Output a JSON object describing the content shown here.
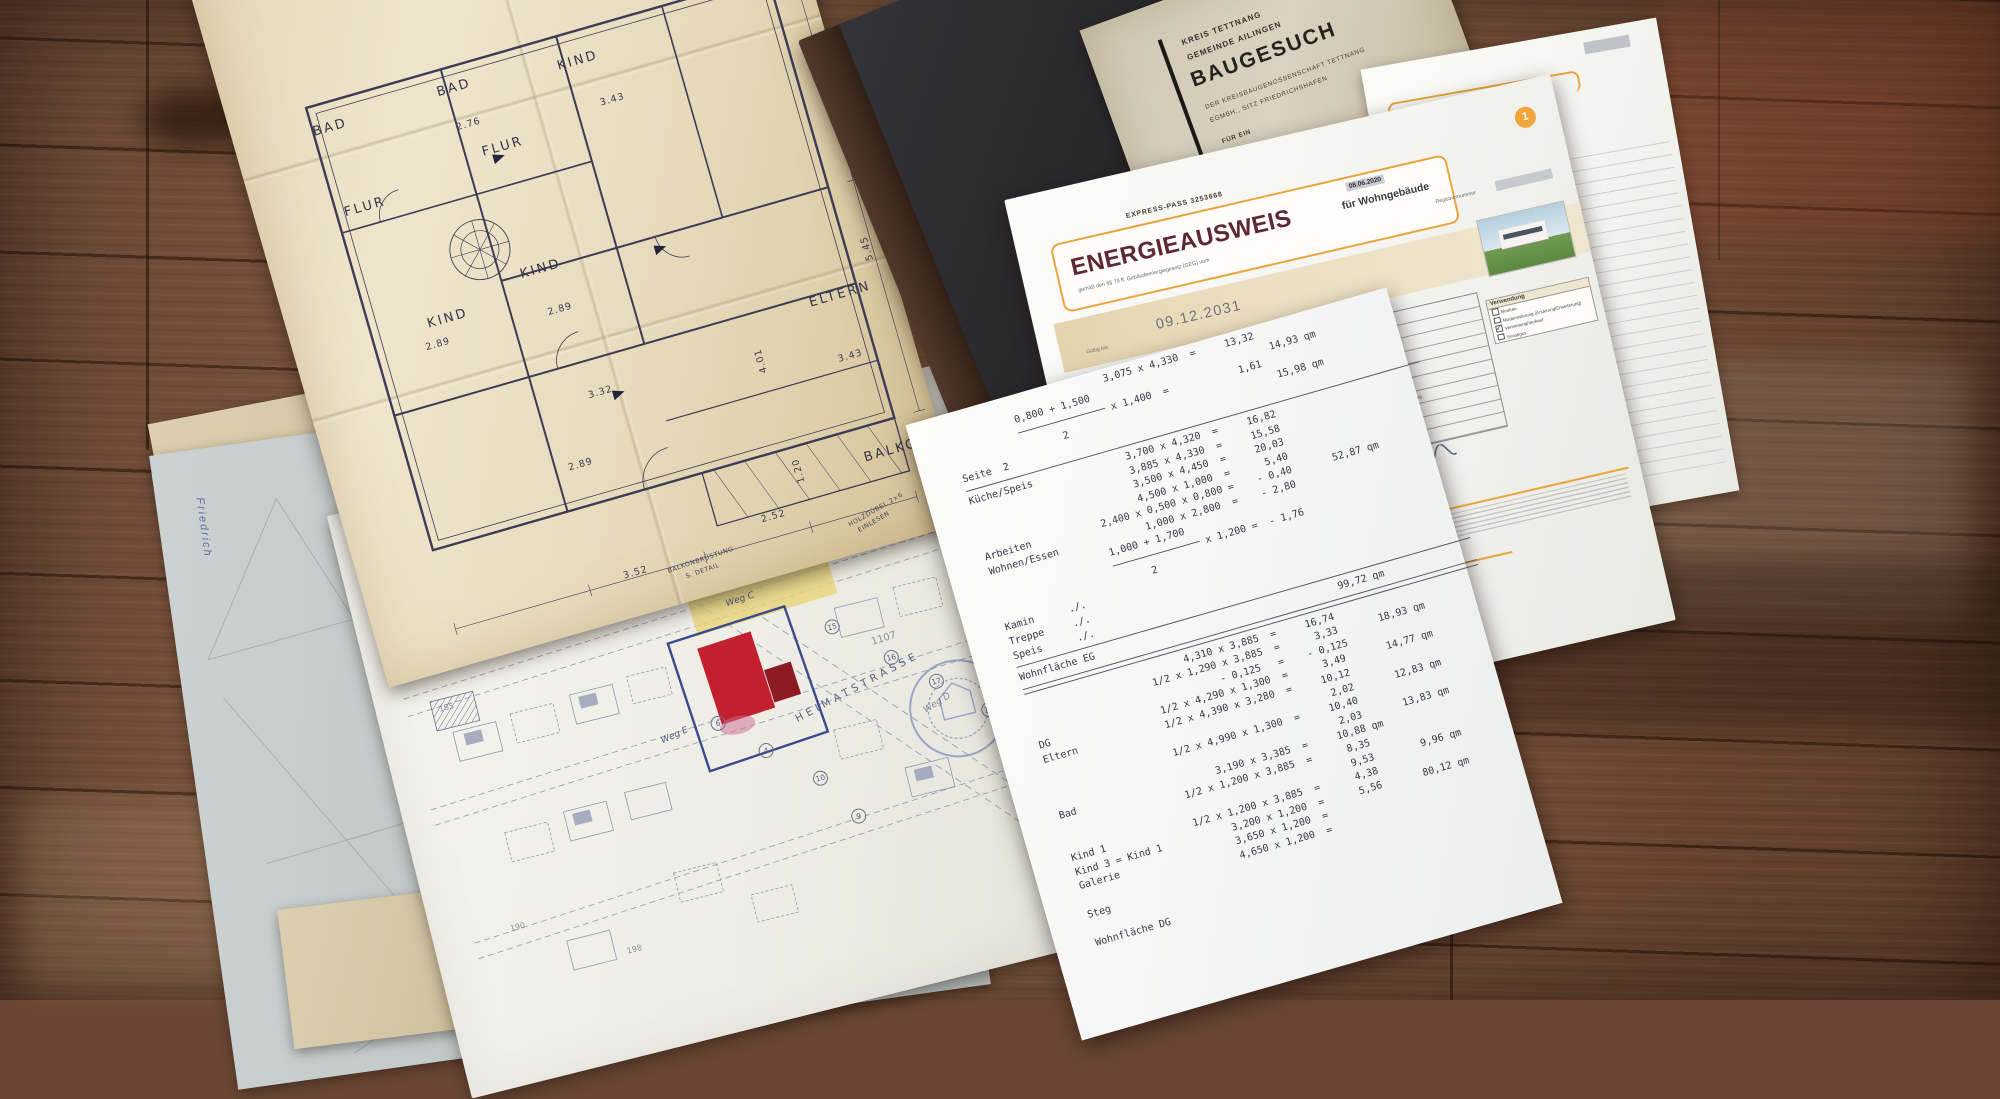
{
  "baugesuch": {
    "kreis": "KREIS TETTNANG",
    "gemeinde": "GEMEINDE AILINGEN",
    "title": "BAUGESUCH",
    "sub1": "DER KREISBAUGENOSSENSCHAFT TETTNANG",
    "sub2": "EGMBH., SITZ FRIEDRICHSHAFEN",
    "fuer": "FÜR EIN",
    "copy": "6. FERTIGUNG"
  },
  "energieausweis": {
    "express": "EXPRESS-PASS 3253668",
    "title": "ENERGIEAUSWEIS",
    "title_suffix": "für Wohngebäude",
    "law": "gemäß den §§ 79 ff. Gebäudeenergiegesetz (GEG) vom",
    "law_date": "08.06.2020",
    "page_badge": "1",
    "reg_label": "Registriernummer",
    "valid_label": "Gültig bis:",
    "valid_date": "09.12.2031",
    "form_values": [
      "Wohngebäude",
      "Objektstandort",
      "Raum Tettnang",
      "Einfamilienhaus",
      "2019",
      "2019",
      "1  (Wohnfläche: 168,0 m²)",
      "226,8 m²",
      "Wärmepumpe - Strom",
      "Wärmepumpe - Strom"
    ],
    "wohnflaeche_note": "nach § 92 GEG aus der Wohnfläche ermittelt",
    "verwendung_label": "Verwendung",
    "checkboxes_left": [
      {
        "t": "Fensterlüftung",
        "c": false
      },
      {
        "t": "Schachtlüftung",
        "c": false
      },
      {
        "t": "Passive Kühlung",
        "c": false
      },
      {
        "t": "Gelieferte Kälte",
        "c": false
      }
    ],
    "checkboxes_mid": [
      {
        "t": "Lüftungsanlage mit Wärmerückgewinnung",
        "c": true
      },
      {
        "t": "Lüftungsanlage ohne Wärmerückgewinnung",
        "c": false
      },
      {
        "t": "Kühlung aus Strom",
        "c": false
      },
      {
        "t": "Kühlung aus Wärme",
        "c": false
      }
    ],
    "checkboxes_right": [
      {
        "t": "Neubau",
        "c": false
      },
      {
        "t": "Modernisierung (Änderung/Erweiterung)",
        "c": false
      },
      {
        "t": "Vermietung/Verkauf",
        "c": true
      },
      {
        "t": "Sonstiges",
        "c": false
      }
    ],
    "anzahl_label": "Anzahl",
    "header1": "Hinweise zu den Angaben über die energetische Qualität des Gebäudes",
    "header2": "Hinweise zur Verwendung des Energieausweises",
    "stamp_date": "09.12.2021"
  },
  "calc_sheet": {
    "lines": [
      {
        "t": "                           3,075 x 4,330  =     13,32"
      },
      {
        "t": "           0,800 + 1,500                               14,93 qm"
      },
      {
        "t": "           ─────────────── x 1,400  =            1,61"
      },
      {
        "t": "                  2                                    15,98 qm"
      },
      {
        "t": "Seite  2"
      },
      {
        "rule": true,
        "w": 472,
        "ml": 0
      },
      {
        "t": "Küche/Speis                3,700 x 4,320  =     16,82"
      },
      {
        "t": "                           3,885 x 4,330  =     15,58"
      },
      {
        "t": "                           3,500 x 4,450  =     20,03"
      },
      {
        "t": "                           4,500 x 1,000  =      5,40"
      },
      {
        "t": "Arbeiten            2,400 x 0,500 x 0,800 =    - 0,40       52,87 qm"
      },
      {
        "t": "Wohnen/Essen               1,000 x 2,800  =    - 2,80"
      },
      {
        "t": "                    1,000 + 1,700"
      },
      {
        "t": "                    ─────────────── x 1,200 =  - 1,76"
      },
      {
        "t": "                          2"
      },
      {
        "t": "Kamin      ./."
      },
      {
        "t": "Treppe     ./."
      },
      {
        "t": "Speis      ./."
      },
      {
        "rule": true,
        "w": 472,
        "ml": 0
      },
      {
        "t": "Wohnfläche EG                                          99,72 qm"
      },
      {
        "rule": true,
        "w": 472,
        "ml": 0
      },
      {
        "rule": true,
        "w": 472,
        "ml": 0
      },
      {
        "t": "                           4,310 x 3,885  =     16,74"
      },
      {
        "t": "                     1/2 x 1,290 x 3,885  =      3,33       18,93 qm"
      },
      {
        "t": "                                - 0,125   =    - 0,125"
      },
      {
        "t": "DG                   1/2 x 4,290 x 1,300  =      3,49       14,77 qm"
      },
      {
        "t": "Eltern               1/2 x 4,390 x 3,280  =     10,12"
      },
      {
        "t": "                                                 2,02       12,83 qm"
      },
      {
        "t": "                     1/2 x 4,990 x 1,300  =     10,40"
      },
      {
        "t": "                                                 2,03       13,83 qm"
      },
      {
        "t": "Bad                        3,190 x 3,385  =     10,88 qm"
      },
      {
        "t": "                     1/2 x 1,200 x 3,885  =      8,35"
      },
      {
        "t": "                                                 9,53        9,96 qm"
      },
      {
        "t": "Kind 1               1/2 x 1,200 x 3,885  =      4,38"
      },
      {
        "t": "Kind 3 = Kind 1            3,200 x 1,200  =      5,56       80,12 qm"
      },
      {
        "t": "Galerie                    3,650 x 1,200  ="
      },
      {
        "t": "                           4,650 x 1,200  ="
      },
      {
        "t": "Steg"
      },
      {
        "t": ""
      },
      {
        "t": "Wohnfläche DG"
      }
    ]
  },
  "floorplan": {
    "rooms": [
      {
        "t": "BAD",
        "x": 210,
        "y": 214
      },
      {
        "t": "BAD",
        "x": 80,
        "y": 218
      },
      {
        "t": "KIND",
        "x": 333,
        "y": 222
      },
      {
        "t": "FLUR",
        "x": 237,
        "y": 284
      },
      {
        "t": "FLUR",
        "x": 88,
        "y": 304
      },
      {
        "t": "KIND",
        "x": 240,
        "y": 412
      },
      {
        "t": "KIND",
        "x": 137,
        "y": 434
      },
      {
        "t": "ELTERN",
        "x": 510,
        "y": 519
      },
      {
        "t": "BALKON",
        "x": 520,
        "y": 683
      }
    ],
    "dims": [
      {
        "t": "3.43",
        "x": 364,
        "y": 271
      },
      {
        "t": "2.76",
        "x": 219,
        "y": 255
      },
      {
        "t": "2.89",
        "x": 256,
        "y": 458
      },
      {
        "t": "2.89",
        "x": 129,
        "y": 458
      },
      {
        "t": "2.89",
        "x": 233,
        "y": 613
      },
      {
        "t": "3.43",
        "x": 522,
        "y": 583
      },
      {
        "t": "3.32",
        "x": 272,
        "y": 549
      },
      {
        "t": "3.52",
        "x": 256,
        "y": 732
      },
      {
        "t": "2.52",
        "x": 404,
        "y": 716
      },
      {
        "t": "1.20",
        "x": 441,
        "y": 679,
        "v": 1
      },
      {
        "t": "5.45",
        "x": 568,
        "y": 484,
        "v": 1
      },
      {
        "t": "4.01",
        "x": 435,
        "y": 563,
        "v": 1
      }
    ],
    "notes": [
      {
        "t": "HOLZDÜBEL 2×6",
        "x": 486,
        "y": 740,
        "r": -14
      },
      {
        "t": "EINLESEN",
        "x": 494,
        "y": 751,
        "r": -14
      },
      {
        "t": "BALKONBRÜSTUNG",
        "x": 300,
        "y": 740,
        "r": -3
      },
      {
        "t": "S. DETAIL",
        "x": 316,
        "y": 751,
        "r": -3
      }
    ]
  },
  "siteplan": {
    "labels": [
      {
        "t": "Weg C",
        "cls": "hand",
        "x": 366,
        "y": 176,
        "r": -4
      },
      {
        "t": "Weg E",
        "cls": "hand",
        "x": 270,
        "y": 292,
        "r": -10
      },
      {
        "t": "Weg D",
        "cls": "hand weak",
        "x": 532,
        "y": 324,
        "r": -18
      },
      {
        "t": "1107",
        "cls": "parcel big",
        "x": 498,
        "y": 248,
        "r": -3
      },
      {
        "t": "185",
        "cls": "parcel",
        "x": 62,
        "y": 210,
        "r": 0
      },
      {
        "t": "190",
        "cls": "parcel",
        "x": 78,
        "y": 440,
        "r": 0
      },
      {
        "t": "198",
        "cls": "parcel",
        "x": 186,
        "y": 490,
        "r": 0
      },
      {
        "t": "HEIMATSTRASSE",
        "cls": "street",
        "x": 404,
        "y": 288,
        "r": -14
      }
    ],
    "circles": [
      {
        "t": "15",
        "x": 456,
        "y": 222
      },
      {
        "t": "16",
        "x": 506,
        "y": 266
      },
      {
        "t": "17",
        "x": 544,
        "y": 300
      },
      {
        "t": "18",
        "x": 588,
        "y": 340
      },
      {
        "t": "4",
        "x": 362,
        "y": 326
      },
      {
        "t": "6",
        "x": 322,
        "y": 288
      },
      {
        "t": "10",
        "x": 408,
        "y": 366
      },
      {
        "t": "9",
        "x": 436,
        "y": 412
      }
    ]
  },
  "misc": {
    "friedrich": "Friedrich"
  }
}
